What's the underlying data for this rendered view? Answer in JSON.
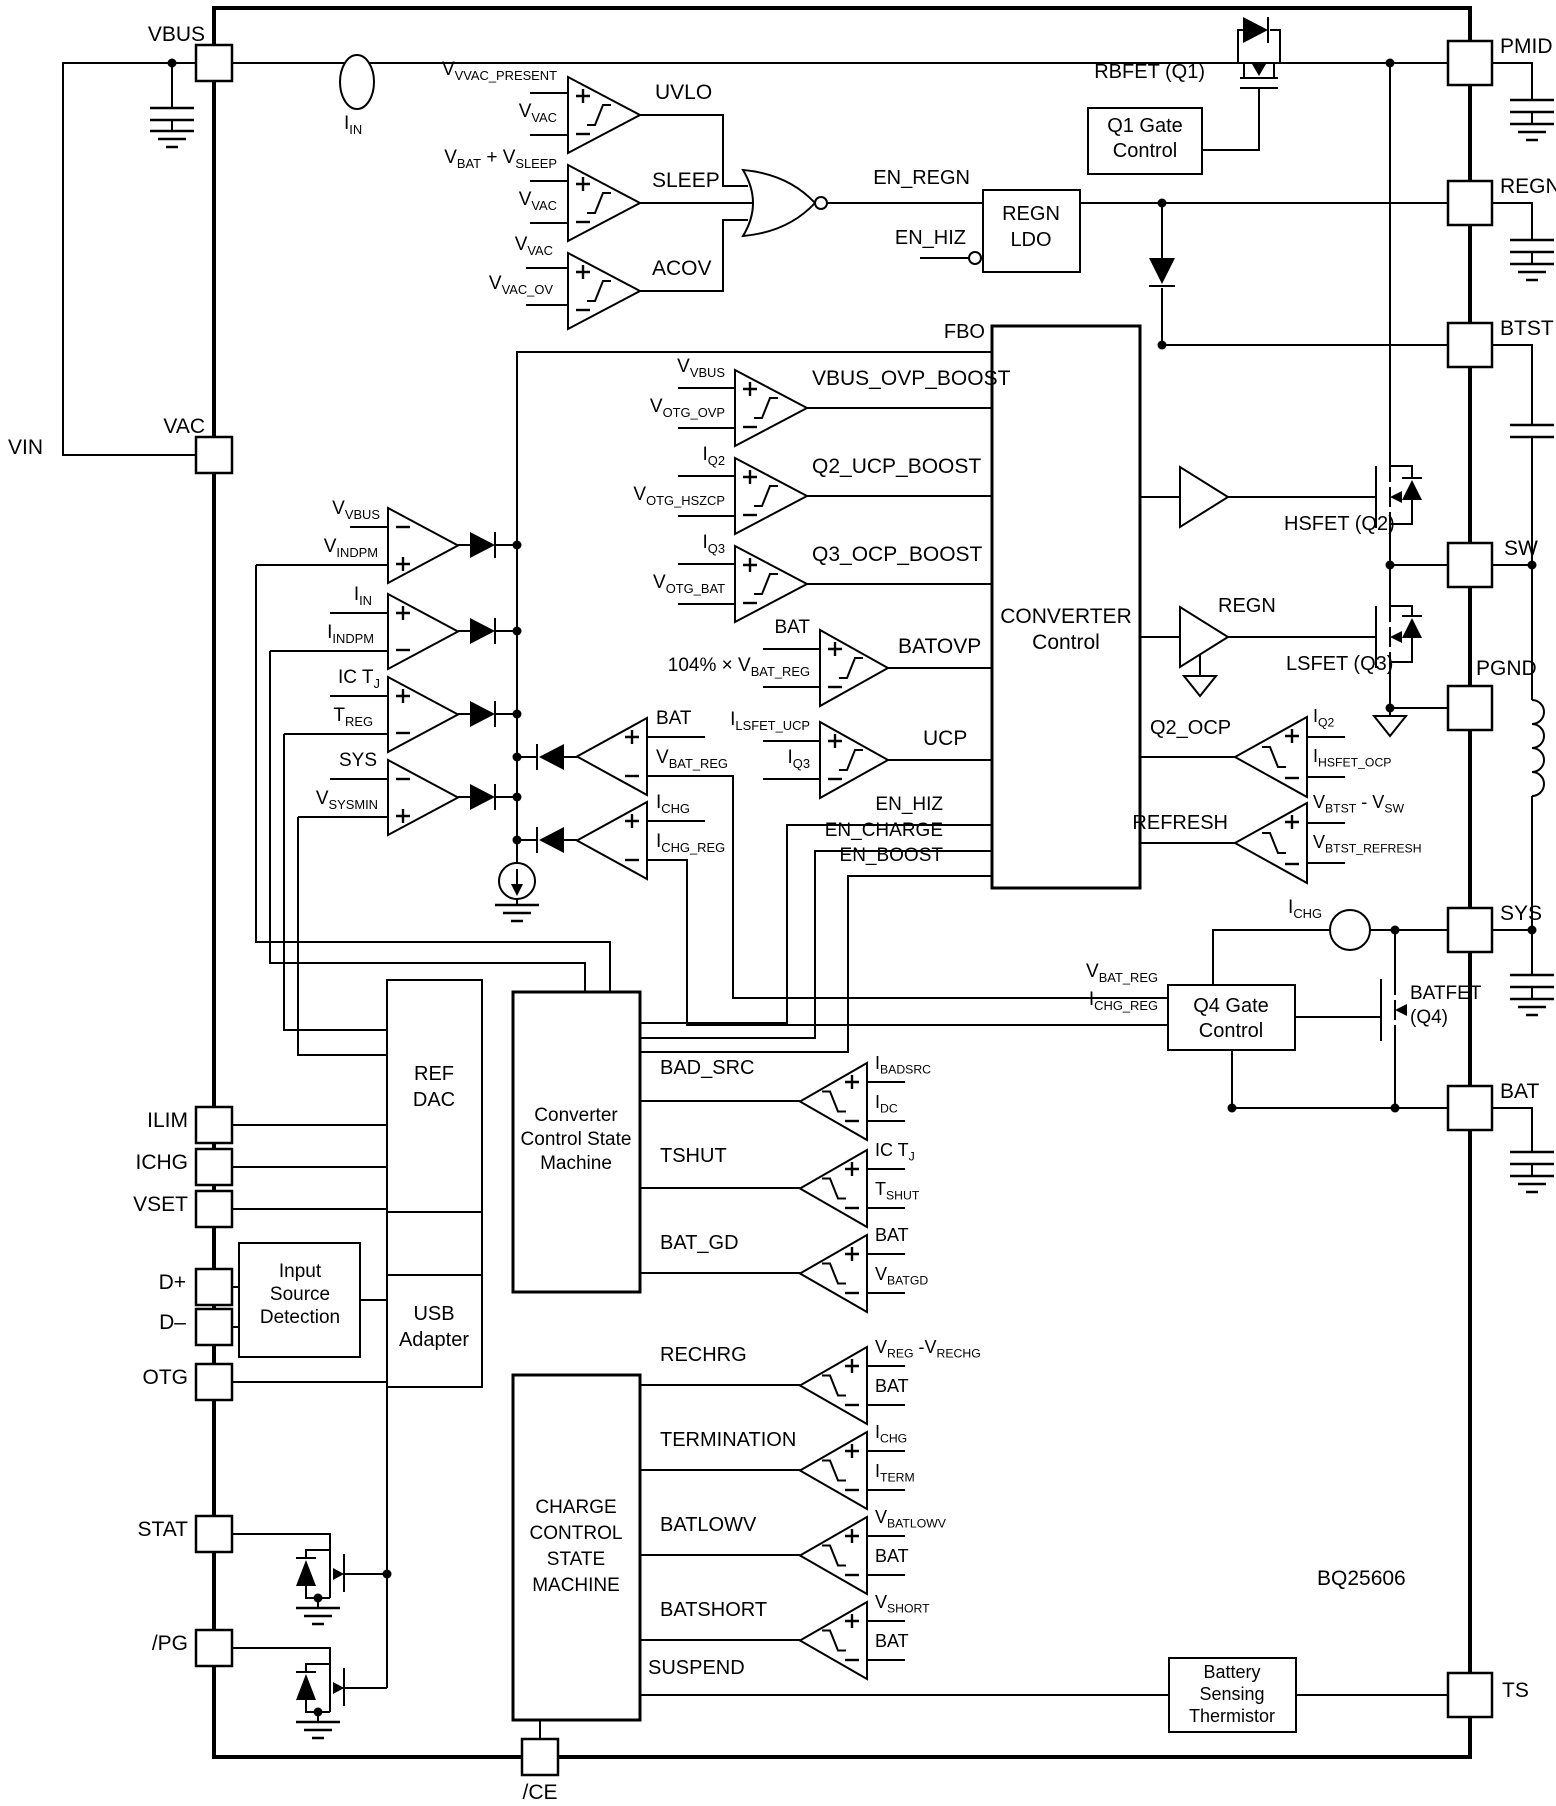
{
  "part": {
    "number": "BQ25606"
  },
  "pins": {
    "vin": "VIN",
    "left": [
      "VBUS",
      "VAC",
      "ILIM",
      "ICHG",
      "VSET",
      "D+",
      "D–",
      "OTG",
      "STAT",
      "/PG"
    ],
    "right": [
      "PMID",
      "REGN",
      "BTST",
      "SW",
      "PGND",
      "SYS",
      "BAT",
      "TS"
    ],
    "bottom": [
      "/CE"
    ]
  },
  "blocks": {
    "q1_gate": {
      "l1": "Q1 Gate",
      "l2": "Control"
    },
    "regn_ldo": {
      "l1": "REGN",
      "l2": "LDO"
    },
    "converter": {
      "l1": "CONVERTER",
      "l2": "Control"
    },
    "ref_dac": {
      "l1": "REF",
      "l2": "DAC"
    },
    "conv_sm": {
      "l1": "Converter",
      "l2": "Control State",
      "l3": "Machine"
    },
    "usb": {
      "l1": "USB",
      "l2": "Adapter"
    },
    "isd": {
      "l1": "Input",
      "l2": "Source",
      "l3": "Detection"
    },
    "charge_sm": {
      "l1": "CHARGE",
      "l2": "CONTROL",
      "l3": "STATE",
      "l4": "MACHINE"
    },
    "q4_gate": {
      "l1": "Q4 Gate",
      "l2": "Control"
    },
    "thermistor": {
      "l1": "Battery",
      "l2": "Sensing",
      "l3": "Thermistor"
    }
  },
  "fets": {
    "rbfet": "RBFET (Q1)",
    "hsfet": "HSFET (Q2)",
    "lsfet": "LSFET (Q3)",
    "batfet_l1": "BATFET",
    "batfet_l2": "(Q4)"
  },
  "comparators": {
    "uvlo": {
      "out": "UVLO",
      "p": "V~VVAC_PRESENT~",
      "m": "V~VAC~"
    },
    "sleep": {
      "out": "SLEEP",
      "p": "V~BAT~ + V~SLEEP~",
      "m": "V~VAC~"
    },
    "acov": {
      "out": "ACOV",
      "p": "V~VAC~",
      "m": "V~VAC_OV~"
    },
    "vbus_ovp": {
      "out": "VBUS_OVP_BOOST",
      "p": "V~VBUS~",
      "m": "V~OTG_OVP~"
    },
    "q2_ucp": {
      "out": "Q2_UCP_BOOST",
      "p": "I~Q2~",
      "m": "V~OTG_HSZCP~"
    },
    "q3_ocp": {
      "out": "Q3_OCP_BOOST",
      "p": "I~Q3~",
      "m": "V~OTG_BAT~"
    },
    "batovp": {
      "out": "BATOVP",
      "p": "BAT",
      "m": "104% × V~BAT_REG~"
    },
    "ucp": {
      "out": "UCP",
      "p": "I~LSFET_UCP~",
      "m": "I~Q3~"
    },
    "q2_ocp": {
      "out": "Q2_OCP",
      "p": "I~Q2~",
      "m": "I~HSFET_OCP~"
    },
    "refresh": {
      "out": "REFRESH",
      "p": "V~BTST~ - V~SW~",
      "m": "V~BTST_REFRESH~"
    },
    "bad_src": {
      "out": "BAD_SRC",
      "p": "I~BADSRC~",
      "m": "I~DC~"
    },
    "tshut": {
      "out": "TSHUT",
      "p": "IC T~J~",
      "m": "T~SHUT~"
    },
    "bat_gd": {
      "out": "BAT_GD",
      "p": "BAT",
      "m": "V~BATGD~"
    },
    "rechrg": {
      "out": "RECHRG",
      "p": "V~REG~ -V~RECHG~",
      "m": "BAT"
    },
    "termination": {
      "out": "TERMINATION",
      "p": "I~CHG~",
      "m": "I~TERM~"
    },
    "batlowv": {
      "out": "BATLOWV",
      "p": "V~BATLOWV~",
      "m": "BAT"
    },
    "batshort": {
      "out": "BATSHORT",
      "p": "V~SHORT~",
      "m": "BAT"
    }
  },
  "amps": {
    "vindpm": {
      "m": "V~VBUS~",
      "p": "V~INDPM~"
    },
    "iindpm": {
      "p": "I~IN~",
      "m": "I~INDPM~"
    },
    "treg": {
      "p": "IC T~J~",
      "m": "T~REG~"
    },
    "sysmin": {
      "m": "SYS",
      "p": "V~SYSMIN~"
    },
    "vbatreg": {
      "p": "BAT",
      "m": "V~BAT_REG~"
    },
    "ichgreg": {
      "p": "I~CHG~",
      "m": "I~CHG_REG~"
    }
  },
  "signals": {
    "en_regn": "EN_REGN",
    "en_hiz": "EN_HIZ",
    "en_charge": "EN_CHARGE",
    "en_boost": "EN_BOOST",
    "fbo": "FBO",
    "suspend": "SUSPEND",
    "regn": "REGN",
    "iin": "I~IN~",
    "ichg": "I~CHG~",
    "vbatreg_in": "V~BAT_REG~",
    "ichgreg_in": "I~CHG_REG~"
  },
  "colors": {
    "line": "#000000",
    "background": "#ffffff"
  }
}
